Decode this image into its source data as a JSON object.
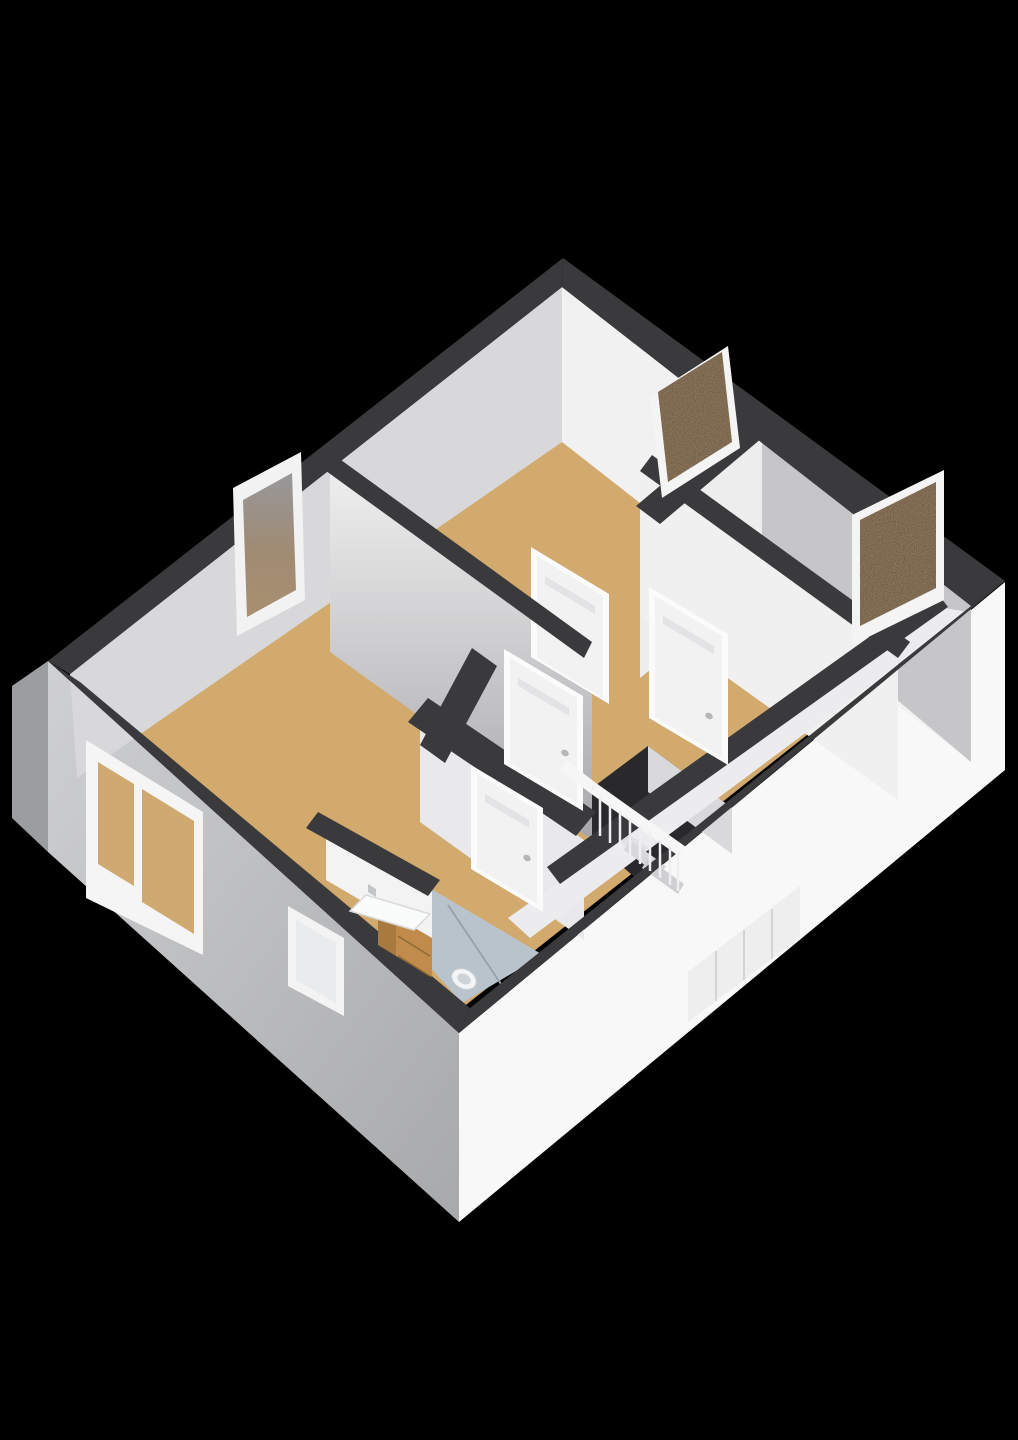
{
  "meta": {
    "description": "3D isometric floor plan render of an upper storey with three bedrooms, landing with stair void and railing, and bathroom",
    "background": "#000000",
    "canvas_width": 1018,
    "canvas_height": 1440
  },
  "palette": {
    "wall_top_band": "#3a3a3c",
    "floor_wood": "#d2aa6d",
    "floor_bathroom": "#b9c3cc",
    "facade_light": "#f8f8f9",
    "facade_shadow": "#b9babc",
    "interior_lit": "#f1f1f2",
    "interior_shadow": "#d8d8da",
    "window_glass_brown": "#b39876",
    "door_white": "#f2f2f3",
    "cabinet_wood": "#c08b4b"
  },
  "scene": [
    {
      "name": "facade-right-exterior",
      "type": "polygon",
      "points": "1005,582 1005,770 459,1222 459,1033",
      "fill": "#f8f8f9"
    },
    {
      "name": "facade-left-exterior",
      "type": "polygon",
      "points": "48,661 459,1033 459,1222 48,852",
      "fill": "url(#gradFL)"
    },
    {
      "name": "facade-left-corner-sliver",
      "type": "polygon",
      "points": "48,661 48,852 12,818 12,686",
      "fill": "#9c9da0"
    },
    {
      "name": "exterior-staircase-volume",
      "type": "polygon",
      "points": "688,1022 688,972 800,886 800,938",
      "fill": "#eeeeef"
    },
    {
      "name": "exterior-staircase-step-line",
      "type": "line",
      "x1": 716,
      "y1": 951,
      "x2": 716,
      "y2": 1001,
      "stroke": "#d4d4d6",
      "w": 2
    },
    {
      "name": "exterior-staircase-step-line",
      "type": "line",
      "x1": 744,
      "y1": 930,
      "x2": 744,
      "y2": 980,
      "stroke": "#d4d4d6",
      "w": 2
    },
    {
      "name": "exterior-staircase-step-line",
      "type": "line",
      "x1": 772,
      "y1": 909,
      "x2": 772,
      "y2": 959,
      "stroke": "#d4d4d6",
      "w": 2
    },
    {
      "name": "floor-wood-all-rooms",
      "type": "polygon",
      "points": "562,288 970,606 457,1012 78,688",
      "fill": "#d2aa6d"
    },
    {
      "name": "floor-bathroom",
      "type": "polygon",
      "points": "433,890 543,955 462,1003 388,920",
      "fill": "#b9c3cc"
    },
    {
      "name": "shower-divider-line",
      "type": "line",
      "x1": 448,
      "y1": 905,
      "x2": 505,
      "y2": 990,
      "stroke": "#98a3ac",
      "w": 2
    },
    {
      "name": "stairwell-void",
      "type": "polygon",
      "points": "560,812 648,746 732,808 640,882",
      "fill": "#29292b"
    },
    {
      "name": "wall-face-top-right-interior",
      "type": "polygon",
      "points": "562,287 971,606 971,762 562,442",
      "fill": "#f1f1f2"
    },
    {
      "name": "wall-face-top-right-shaded",
      "type": "polygon",
      "points": "757,428 971,606 971,762 757,582",
      "fill": "#c6c6c8"
    },
    {
      "name": "wall-face-top-left-interior",
      "type": "polygon",
      "points": "562,287 70,674 77,778 562,442",
      "fill": "#d8d8da"
    },
    {
      "name": "wall-face-partition-bedroom1",
      "type": "polygon",
      "points": "330,461 592,650 592,840 330,652",
      "fill": "url(#gradV0)"
    },
    {
      "name": "wall-face-partition-bedrooms",
      "type": "polygon",
      "points": "762,434 640,532 640,678 762,580",
      "fill": "#ededee"
    },
    {
      "name": "wall-face-bedroom2-hall",
      "type": "polygon",
      "points": "640,471 898,656 898,800 640,615",
      "fill": "#f0f0f1"
    },
    {
      "name": "wall-face-bathroom-hall",
      "type": "polygon",
      "points": "420,722 584,840 584,940 420,822",
      "fill": "#e9e9eb"
    },
    {
      "name": "wall-face-sink-wall",
      "type": "polygon",
      "points": "326,826 432,888 432,942 326,880",
      "fill": "#f3f3f4"
    },
    {
      "name": "wall-face-stair-parapet",
      "type": "polygon",
      "points": "648,746 732,808 732,854 648,792",
      "fill": "#d9d9db"
    },
    {
      "name": "stairwell-outer-strip",
      "type": "polygon",
      "points": "945,608 968,612 530,938 508,918",
      "fill": "#ececee"
    },
    {
      "name": "stair-step",
      "type": "polygon",
      "points": "612,822 648,848 642,858 606,832",
      "fill": "#e2e2e4"
    },
    {
      "name": "stair-step",
      "type": "polygon",
      "points": "630,840 666,866 660,876 624,850",
      "fill": "#d8d8da"
    },
    {
      "name": "stair-step",
      "type": "polygon",
      "points": "648,858 684,884 678,894 642,868",
      "fill": "#cfcfd1"
    },
    {
      "name": "door-frame-bedroom1-inner",
      "type": "polygon",
      "points": "531,547 609,594 609,704 531,657",
      "fill": "#fbfbfc"
    },
    {
      "name": "door-bedroom1-inner",
      "type": "polygon",
      "points": "537,556 603,596 603,698 537,658",
      "fill": "#f2f2f3"
    },
    {
      "name": "door-vent-bedroom1-inner",
      "type": "polygon",
      "points": "545,576 595,606 595,614 545,584",
      "fill": "#e3e3e5"
    },
    {
      "name": "wall-top-band-north",
      "type": "polygon",
      "points": "563,258 1005,581 971,606 562,287",
      "fill": "#3a3a3c"
    },
    {
      "name": "wall-top-band-west",
      "type": "polygon",
      "points": "563,258 48,661 70,674 562,287",
      "fill": "#3a3a3c"
    },
    {
      "name": "wall-top-band-south-west",
      "type": "polygon",
      "points": "48,661 459,1033 470,1008 80,682",
      "fill": "#3a3a3c"
    },
    {
      "name": "wall-top-band-south-east",
      "type": "polygon",
      "points": "1005,581 459,1033 470,1008 971,606",
      "fill": "#3a3a3c"
    },
    {
      "name": "wall-top-band-partition-bedroom1",
      "type": "polygon",
      "points": "330,452 592,642 584,658 322,468",
      "fill": "#3a3a3c"
    },
    {
      "name": "wall-top-band-bedroom2-hall",
      "type": "polygon",
      "points": "652,455 910,642 898,658 640,471",
      "fill": "#3a3a3c"
    },
    {
      "name": "wall-top-band-bedrooms-partition",
      "type": "polygon",
      "points": "745,414 769,432 660,524 636,506",
      "fill": "#3a3a3c"
    },
    {
      "name": "wall-top-band-hall-left",
      "type": "polygon",
      "points": "472,648 497,666 445,763 420,745",
      "fill": "#3a3a3c"
    },
    {
      "name": "wall-top-band-bathroom",
      "type": "polygon",
      "points": "428,698 596,812 576,836 408,722",
      "fill": "#3a3a3c"
    },
    {
      "name": "wall-top-band-sink-wall",
      "type": "polygon",
      "points": "318,812 440,880 428,896 306,828",
      "fill": "#3a3a3c"
    },
    {
      "name": "wall-top-band-stairwell",
      "type": "polygon",
      "points": "935,590 948,607 560,884 547,867",
      "fill": "#3a3a3c"
    },
    {
      "name": "window-frame-bedroom1-north",
      "type": "polygon",
      "points": "650,396 728,346 740,448 662,498",
      "fill": "#f4f4f5"
    },
    {
      "name": "window-glass-bedroom1-north",
      "type": "polygon",
      "points": "658,392 722,352 732,442 668,482",
      "fill": "#b39876",
      "filter": "url(#speckle)"
    },
    {
      "name": "window-frame-bedroom2-east",
      "type": "polygon",
      "points": "852,515 944,470 944,600 852,645",
      "fill": "#f4f4f5"
    },
    {
      "name": "window-glass-bedroom2-east",
      "type": "polygon",
      "points": "860,520 936,482 936,588 860,626",
      "fill": "#b39876",
      "filter": "url(#speckle)"
    },
    {
      "name": "window-frame-bedroom1-west",
      "type": "polygon",
      "points": "233,488 301,452 305,600 237,636",
      "fill": "#f2f2f3"
    },
    {
      "name": "window-glass-bedroom1-west",
      "type": "polygon",
      "points": "243,500 292,473 296,590 247,617",
      "fill": "url(#gradWin3)"
    },
    {
      "name": "window-frame-livingroom-double",
      "type": "polygon",
      "points": "86,740 203,812 203,955 86,898",
      "fill": "#f5f5f6"
    },
    {
      "name": "window-glass-livingroom-left",
      "type": "polygon",
      "points": "98,762 134,784 134,886 98,864",
      "fill": "#cfa96f"
    },
    {
      "name": "window-glass-livingroom-right",
      "type": "polygon",
      "points": "142,789 194,821 194,934 142,902",
      "fill": "#cfa96f"
    },
    {
      "name": "window-frame-bathroom-frosted",
      "type": "polygon",
      "points": "288,906 344,938 344,1016 288,986",
      "fill": "#f3f3f4"
    },
    {
      "name": "window-glass-bathroom-frosted",
      "type": "polygon",
      "points": "296,920 336,943 336,1003 296,980",
      "fill": "#e9ebed"
    },
    {
      "name": "door-frame-livingroom",
      "type": "polygon",
      "points": "504,649 583,696 583,811 504,764",
      "fill": "#fbfbfc"
    },
    {
      "name": "door-livingroom",
      "type": "polygon",
      "points": "510,658 577,698 577,803 510,763",
      "fill": "#f2f2f3"
    },
    {
      "name": "door-vent-livingroom",
      "type": "polygon",
      "points": "518,678 569,708 569,716 518,686",
      "fill": "#e3e3e5"
    },
    {
      "name": "door-handle-livingroom",
      "type": "ellipse",
      "cx": 565,
      "cy": 753,
      "rx": 4,
      "ry": 3,
      "rot": 30,
      "fill": "#b6b6b8"
    },
    {
      "name": "door-frame-bedroom2",
      "type": "polygon",
      "points": "649,587 728,634 728,765 649,718",
      "fill": "#fbfbfc"
    },
    {
      "name": "door-bedroom2",
      "type": "polygon",
      "points": "655,596 722,636 722,757 655,717",
      "fill": "#f2f2f3"
    },
    {
      "name": "door-vent-bedroom2",
      "type": "polygon",
      "points": "663,616 714,646 714,654 663,624",
      "fill": "#e3e3e5"
    },
    {
      "name": "door-handle-bedroom2",
      "type": "ellipse",
      "cx": 709,
      "cy": 716,
      "rx": 4,
      "ry": 3,
      "rot": 30,
      "fill": "#b6b6b8"
    },
    {
      "name": "door-frame-bathroom",
      "type": "polygon",
      "points": "471,765 543,808 543,912 471,869",
      "fill": "#fbfbfc"
    },
    {
      "name": "door-bathroom",
      "type": "polygon",
      "points": "477,774 537,810 537,904 477,868",
      "fill": "#f2f2f3"
    },
    {
      "name": "door-vent-bathroom",
      "type": "polygon",
      "points": "485,794 529,820 529,828 485,802",
      "fill": "#e3e3e5"
    },
    {
      "name": "door-handle-bathroom",
      "type": "ellipse",
      "cx": 527,
      "cy": 858,
      "rx": 4,
      "ry": 3,
      "rot": 30,
      "fill": "#b6b6b8"
    },
    {
      "name": "stair-railing-cap",
      "type": "polygon",
      "points": "596,783 686,847 680,857 590,793",
      "fill": "#f6f6f7"
    },
    {
      "name": "stair-railing-return",
      "type": "polygon",
      "points": "566,760 596,783 590,793 560,770",
      "fill": "#f6f6f7"
    },
    {
      "name": "stair-baluster",
      "type": "line",
      "x1": 600,
      "y1": 797,
      "x2": 600,
      "y2": 836,
      "stroke": "#efeff1",
      "w": 2.5
    },
    {
      "name": "stair-baluster",
      "type": "line",
      "x1": 610,
      "y1": 804,
      "x2": 610,
      "y2": 843,
      "stroke": "#efeff1",
      "w": 2.5
    },
    {
      "name": "stair-baluster",
      "type": "line",
      "x1": 620,
      "y1": 811,
      "x2": 620,
      "y2": 850,
      "stroke": "#efeff1",
      "w": 2.5
    },
    {
      "name": "stair-baluster",
      "type": "line",
      "x1": 630,
      "y1": 818,
      "x2": 630,
      "y2": 857,
      "stroke": "#efeff1",
      "w": 2.5
    },
    {
      "name": "stair-baluster",
      "type": "line",
      "x1": 640,
      "y1": 825,
      "x2": 640,
      "y2": 864,
      "stroke": "#efeff1",
      "w": 2.5
    },
    {
      "name": "stair-baluster",
      "type": "line",
      "x1": 650,
      "y1": 832,
      "x2": 650,
      "y2": 871,
      "stroke": "#efeff1",
      "w": 2.5
    },
    {
      "name": "stair-baluster",
      "type": "line",
      "x1": 660,
      "y1": 839,
      "x2": 660,
      "y2": 878,
      "stroke": "#efeff1",
      "w": 2.5
    },
    {
      "name": "stair-baluster",
      "type": "line",
      "x1": 670,
      "y1": 846,
      "x2": 670,
      "y2": 885,
      "stroke": "#efeff1",
      "w": 2.5
    },
    {
      "name": "stair-baluster",
      "type": "line",
      "x1": 678,
      "y1": 852,
      "x2": 678,
      "y2": 891,
      "stroke": "#efeff1",
      "w": 2.5
    },
    {
      "name": "sink-cabinet-side",
      "type": "polygon",
      "points": "378,906 396,917 396,956 378,945",
      "fill": "#a87a40"
    },
    {
      "name": "sink-cabinet-front",
      "type": "polygon",
      "points": "396,917 432,938 432,977 396,956",
      "fill": "#c08b4b"
    },
    {
      "name": "sink-drawer-line",
      "type": "line",
      "x1": 398,
      "y1": 936,
      "x2": 430,
      "y2": 956,
      "stroke": "#8f6a35",
      "w": 1.5
    },
    {
      "name": "sink-drawer-line",
      "type": "line",
      "x1": 398,
      "y1": 956,
      "x2": 430,
      "y2": 976,
      "stroke": "#8f6a35",
      "w": 1.5
    },
    {
      "name": "sink-basin",
      "type": "polygon",
      "points": "366,895 430,914 414,930 350,911",
      "fill": "#fafbfb",
      "stroke": "#d9d9db",
      "w": 1.5
    },
    {
      "name": "sink-faucet",
      "type": "polygon",
      "points": "368,884 376,889 376,897 368,892",
      "fill": "#c2c4c6"
    },
    {
      "name": "toilet-bowl",
      "type": "ellipse",
      "cx": 464,
      "cy": 979,
      "rx": 13,
      "ry": 9.5,
      "rot": 28,
      "fill": "#f3f4f5",
      "stroke": "#c9cdd2",
      "w": 1
    },
    {
      "name": "toilet-seat",
      "type": "ellipse",
      "cx": 464,
      "cy": 979,
      "rx": 7,
      "ry": 5,
      "rot": 28,
      "fill": "#ced3d8"
    }
  ]
}
